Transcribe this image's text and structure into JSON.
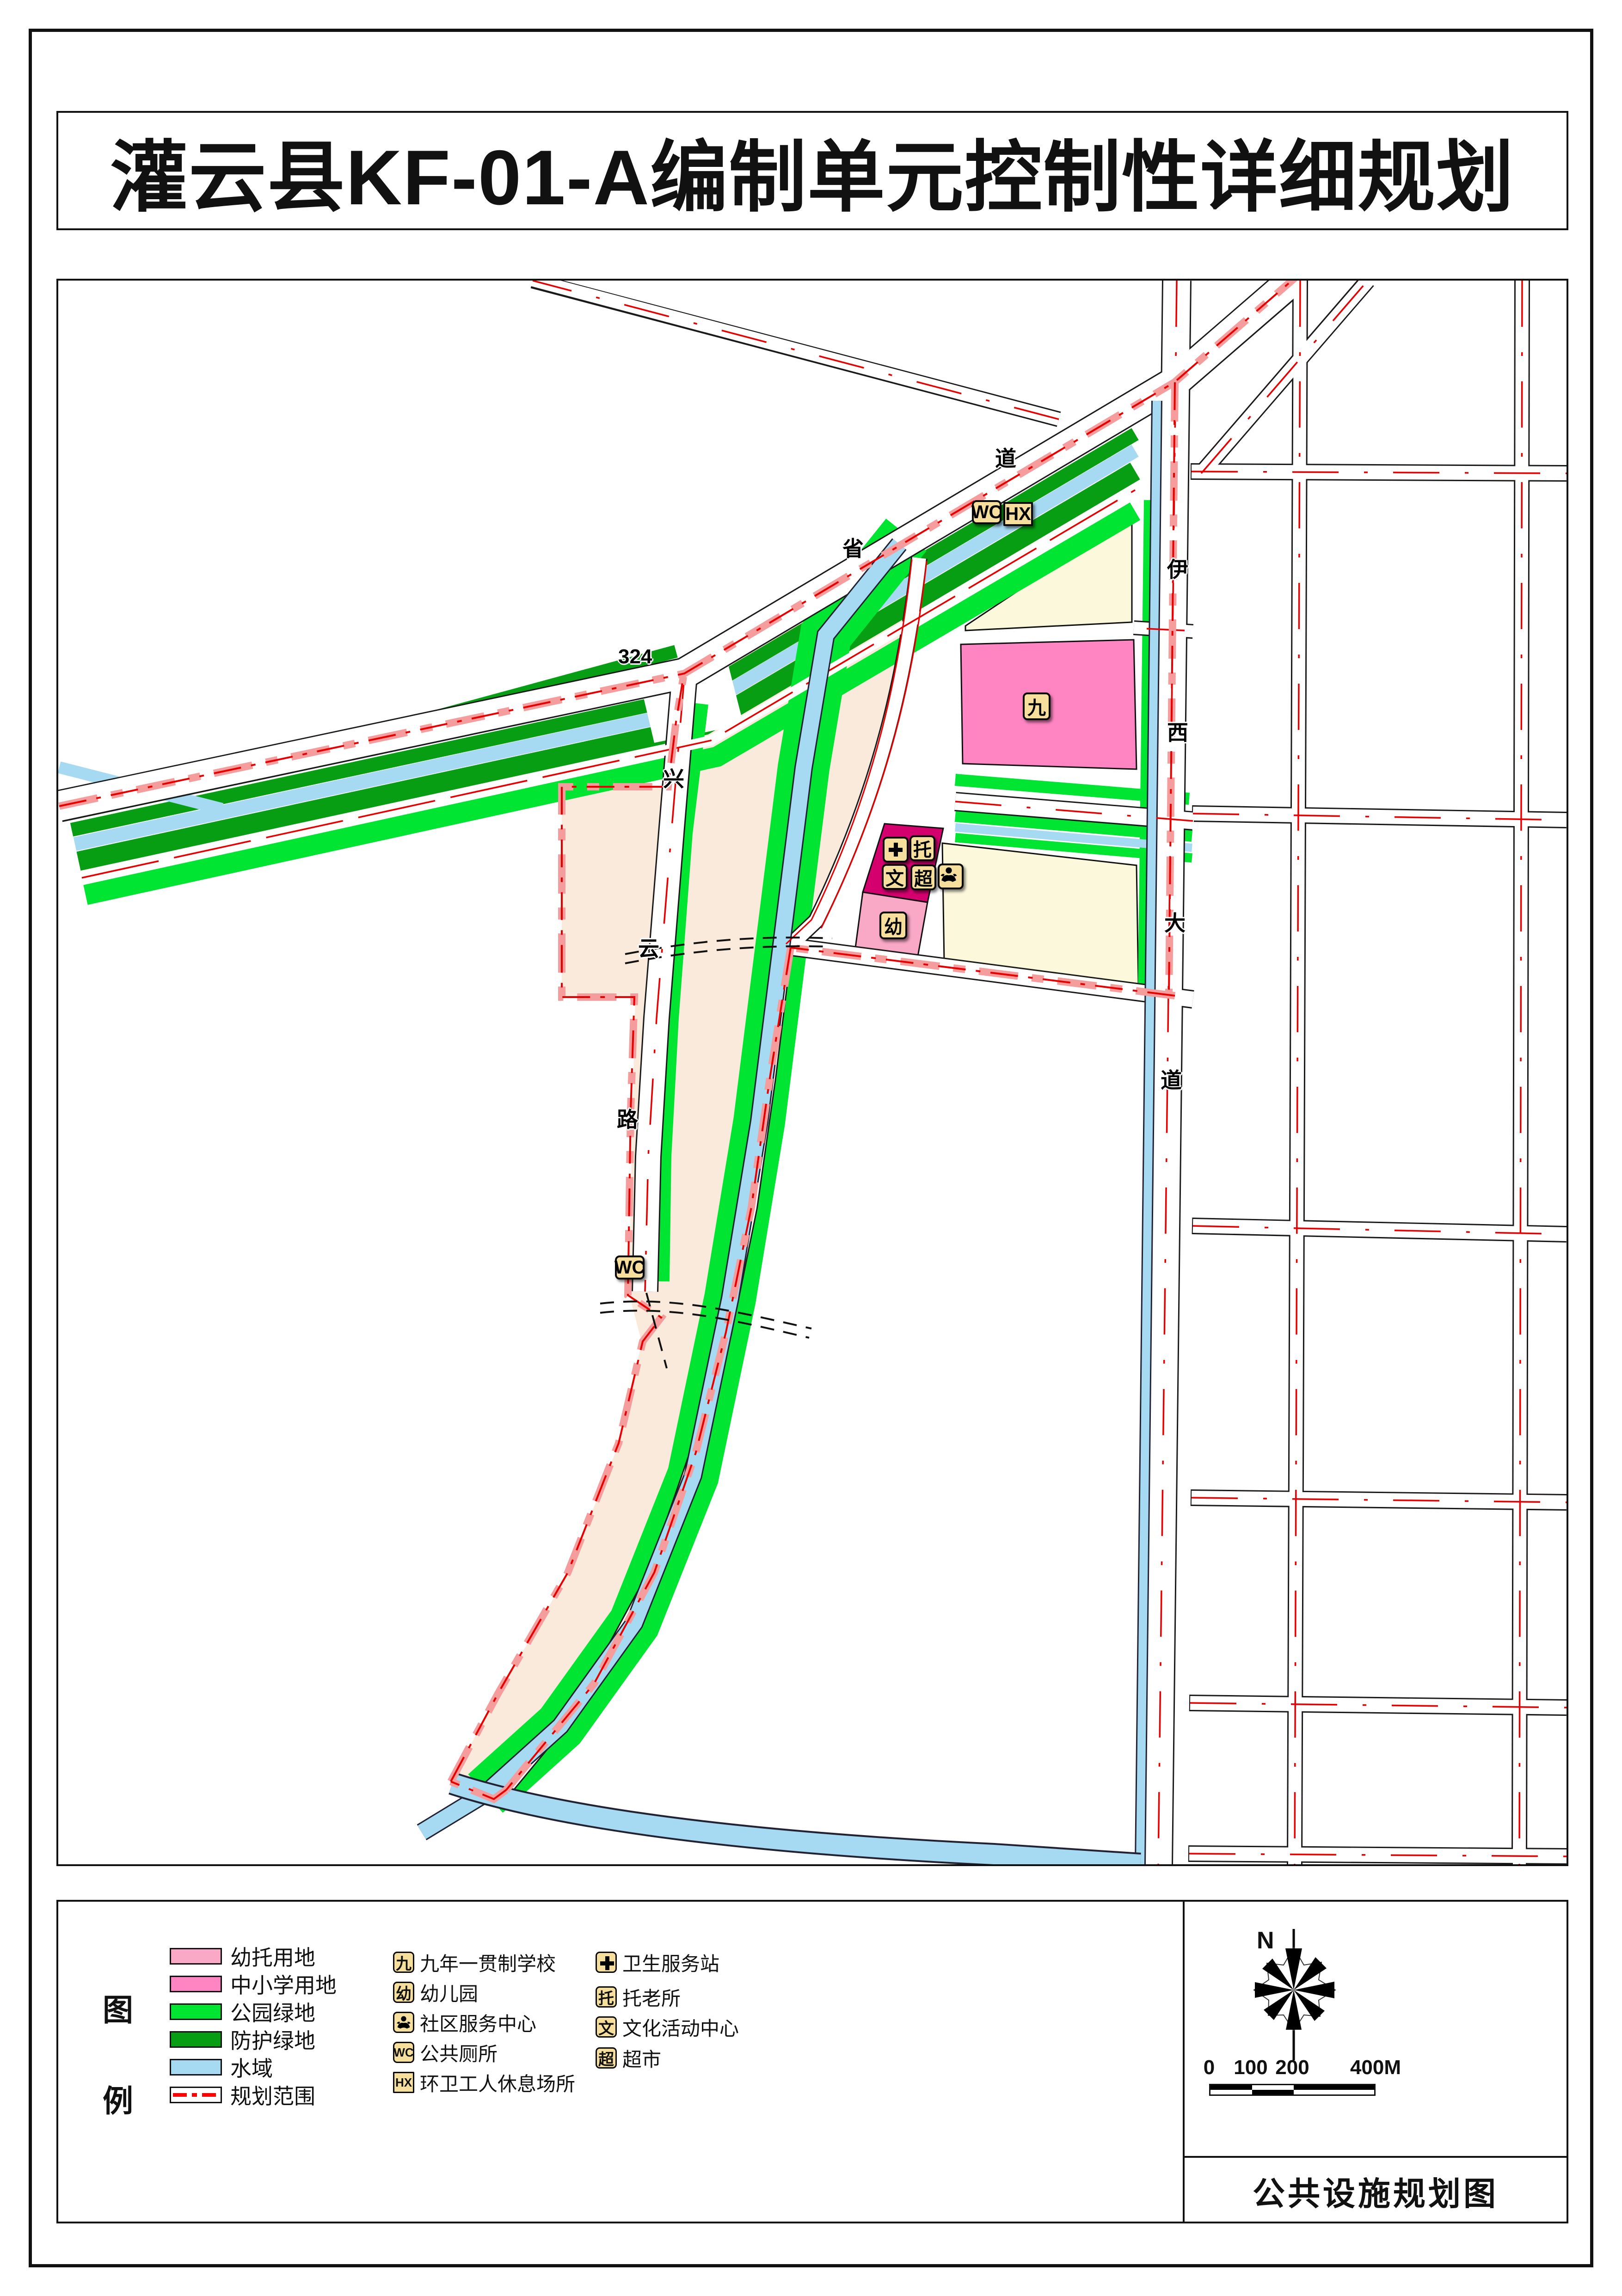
{
  "page": {
    "title": "灌云县KF-01-A编制单元控制性详细规划"
  },
  "map": {
    "road_labels": [
      {
        "id": "provincial-char-1",
        "text": "省"
      },
      {
        "id": "provincial-char-2",
        "text": "道"
      },
      {
        "id": "provincial-number",
        "text": "324"
      },
      {
        "id": "xingyun-char-1",
        "text": "兴"
      },
      {
        "id": "xingyun-char-2",
        "text": "云"
      },
      {
        "id": "xingyun-char-3",
        "text": "路"
      },
      {
        "id": "yixi-char-1",
        "text": "伊"
      },
      {
        "id": "yixi-char-2",
        "text": "西"
      },
      {
        "id": "yixi-char-3",
        "text": "大"
      },
      {
        "id": "yixi-char-4",
        "text": "道"
      }
    ],
    "facilities": [
      {
        "id": "public-toilet-north",
        "text": "WC"
      },
      {
        "id": "sanitation-rest-station",
        "text": "HX"
      },
      {
        "id": "nine-year-school",
        "text": "九"
      },
      {
        "id": "health-service-station",
        "icon": "cross"
      },
      {
        "id": "elderly-care",
        "text": "托"
      },
      {
        "id": "culture-center",
        "text": "文"
      },
      {
        "id": "supermarket",
        "text": "超"
      },
      {
        "id": "community-service-center",
        "icon": "person"
      },
      {
        "id": "kindergarten",
        "text": "幼"
      },
      {
        "id": "public-toilet-south",
        "text": "WC"
      }
    ],
    "colors": {
      "nursery_landuse": "#F9A8C5",
      "school_landuse": "#FF85C2",
      "park_green": "#00E432",
      "protective_green": "#089E14",
      "water": "#A6D9F2",
      "boundary_red": "#FF0000",
      "boundary_salmon": "#F59C9C",
      "facility_parcel_magenta": "#D4006E",
      "existing_area_cream": "#FAEADC",
      "village_parcel_yellow": "#FCF8DC",
      "badge_bg": "#F6DF9D"
    }
  },
  "legend": {
    "title_chars": [
      {
        "text": "图"
      },
      {
        "text": "例"
      }
    ],
    "landuse": [
      {
        "label": "幼托用地",
        "color": "#F9A8C5"
      },
      {
        "label": "中小学用地",
        "color": "#FF85C2"
      },
      {
        "label": "公园绿地",
        "color": "#00E432"
      },
      {
        "label": "防护绿地",
        "color": "#089E14"
      },
      {
        "label": "水域",
        "color": "#A6D9F2"
      },
      {
        "label": "规划范围",
        "color": "#FF0000"
      }
    ],
    "symbols": [
      {
        "glyph": "九",
        "label": "九年一贯制学校"
      },
      {
        "glyph": "幼",
        "label": "幼儿园"
      },
      {
        "glyph": "person",
        "label": "社区服务中心"
      },
      {
        "glyph": "WC",
        "label": "公共厕所"
      },
      {
        "glyph": "HX",
        "label": "环卫工人休息场所"
      },
      {
        "glyph": "cross",
        "label": "卫生服务站"
      },
      {
        "glyph": "托",
        "label": "托老所"
      },
      {
        "glyph": "文",
        "label": "文化活动中心"
      },
      {
        "glyph": "超",
        "label": "超市"
      }
    ]
  },
  "panel": {
    "north_label": "N",
    "scale": {
      "ticks": [
        "0",
        "100",
        "200",
        "400M"
      ]
    },
    "title": "公共设施规划图"
  }
}
